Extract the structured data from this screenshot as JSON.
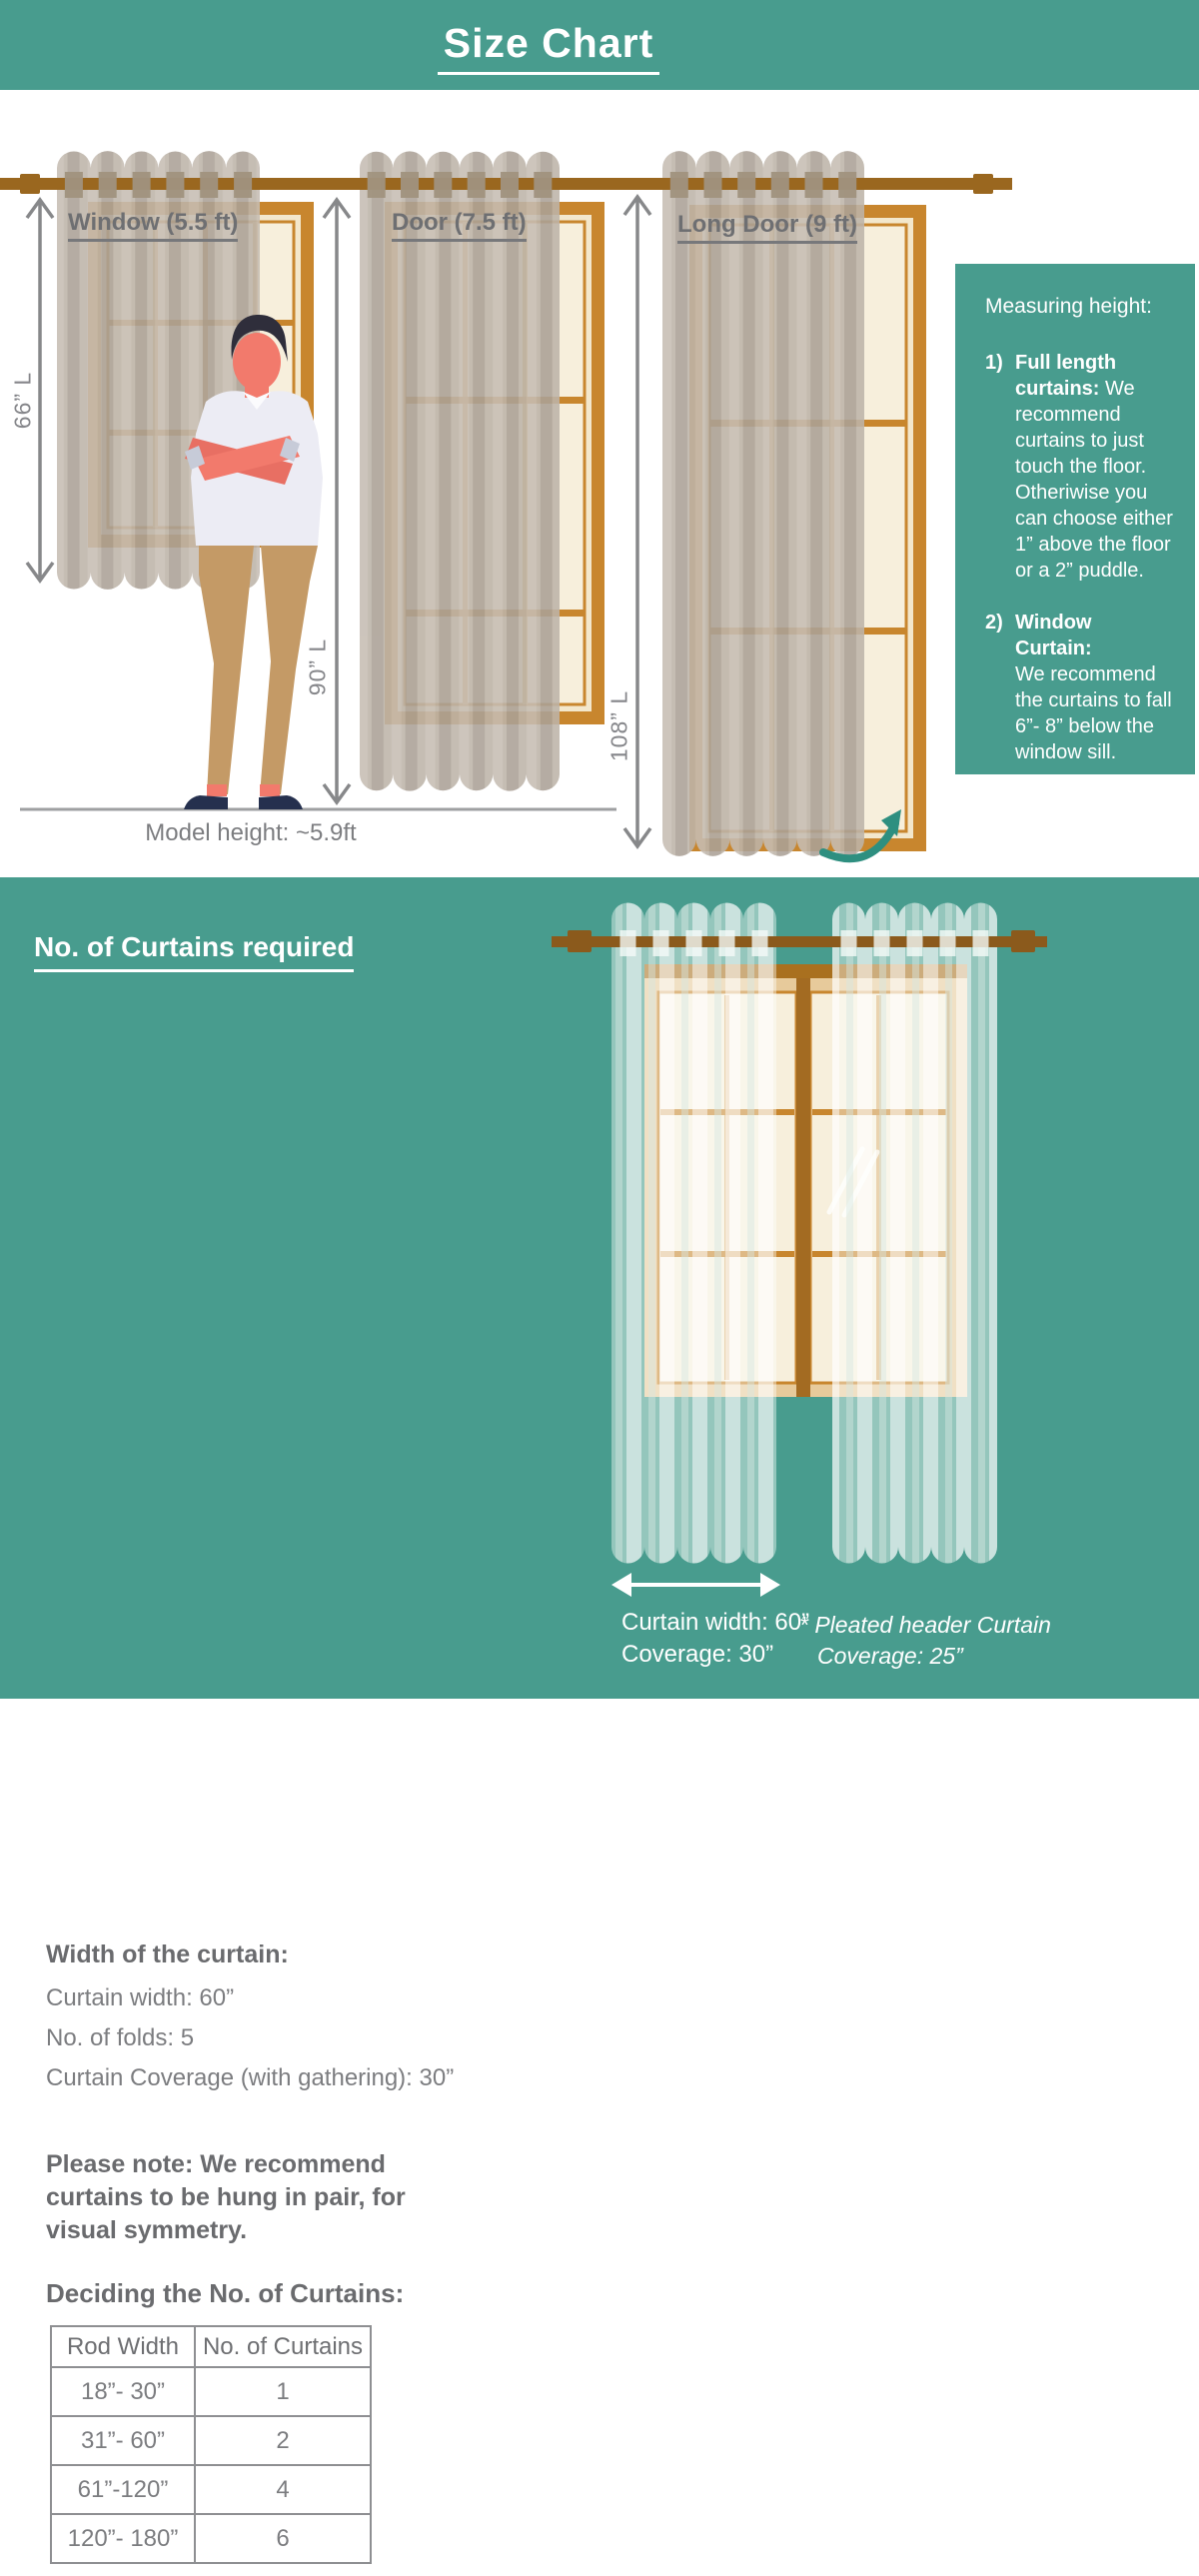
{
  "title": "Size Chart",
  "colors": {
    "teal": "#489c8e",
    "teal_arrow": "#2e8f80",
    "rod_brown": "#9a671f",
    "rod_brown_dark": "#8b5a1c",
    "frame_orange": "#c8862e",
    "pane_cream": "#f7efdc",
    "curtain_taupe": "#bdb4a9",
    "text_gray_bold": "#6e6f72",
    "text_gray": "#7c7d80",
    "white": "#ffffff"
  },
  "size_diagram": {
    "items": [
      {
        "label": "Window (5.5 ft)",
        "length": "66” L"
      },
      {
        "label": "Door (7.5 ft)",
        "length": "90” L"
      },
      {
        "label": "Long Door (9 ft)",
        "length": "108” L"
      }
    ],
    "model_height": "Model height: ~5.9ft",
    "measuring_box": {
      "title": "Measuring height:",
      "items": [
        {
          "num": "1)",
          "bold": "Full length curtains:",
          "text": "We recommend curtains to just touch the floor. Otheriwise you can choose either 1” above the floor or a 2” puddle."
        },
        {
          "num": "2)",
          "bold": "Window Curtain:",
          "text": "We recommend the curtains to fall 6”- 8” below the window sill."
        }
      ]
    }
  },
  "curtains_required": {
    "heading": "No. of Curtains required",
    "width_title": "Width of the curtain:",
    "width_lines": [
      "Curtain width: 60”",
      "No. of folds: 5",
      "Curtain Coverage (with gathering): 30”"
    ],
    "note": "Please note: We recommend curtains to be hung in pair, for visual symmetry.",
    "table_title": "Deciding the No. of Curtains:",
    "table": {
      "headers": [
        "Rod Width",
        "No. of Curtains"
      ],
      "rows": [
        [
          "18”- 30”",
          "1"
        ],
        [
          "31”- 60”",
          "2"
        ],
        [
          "61”-120”",
          "4"
        ],
        [
          "120”- 180”",
          "6"
        ]
      ]
    },
    "illustration": {
      "width_label": "Curtain width: 60”",
      "coverage_label": "Coverage: 30”",
      "note_line1": "* Pleated header Curtain",
      "note_line2": "Coverage: 25”"
    }
  }
}
